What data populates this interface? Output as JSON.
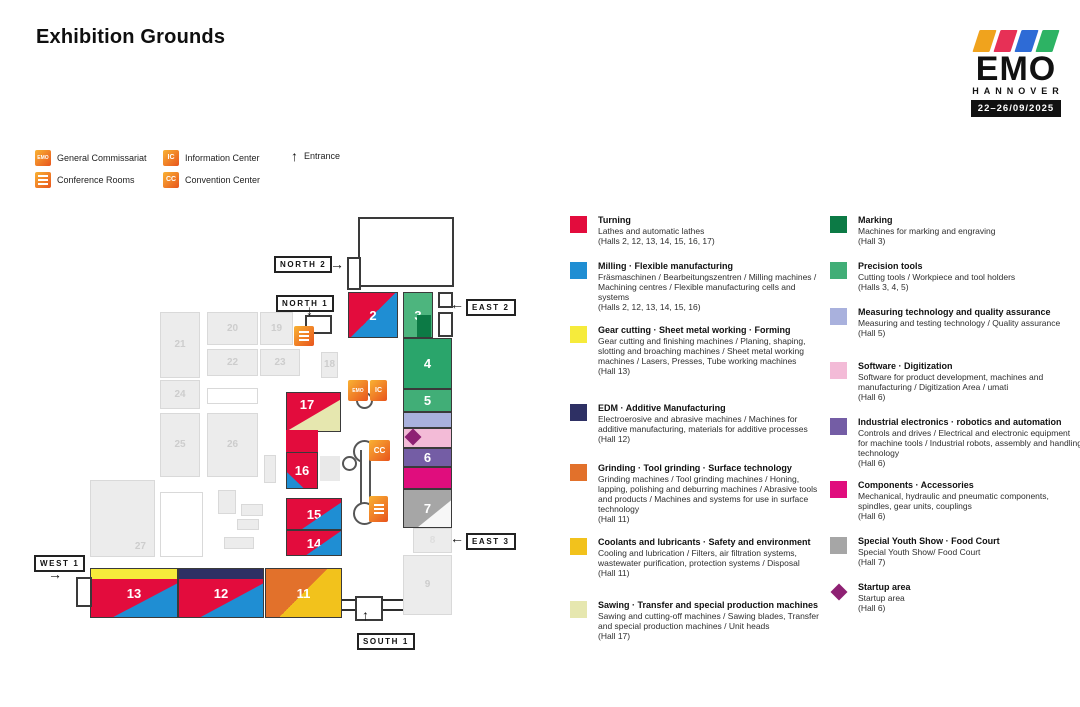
{
  "page": {
    "title": "Exhibition Grounds"
  },
  "logo": {
    "brand": "EMO",
    "city": "HANNOVER",
    "dates": "22–26/09/2025",
    "stripes": [
      "#f0a31d",
      "#e73056",
      "#2e6bd6",
      "#2db364"
    ]
  },
  "map_key": {
    "general_commissariat": {
      "glyph": "EMO",
      "label": "General Commissariat"
    },
    "information_center": {
      "glyph": "IC",
      "label": "Information Center"
    },
    "conference_rooms": {
      "glyph": "",
      "label": "Conference Rooms"
    },
    "convention_center": {
      "glyph": "CC",
      "label": "Convention Center"
    },
    "entrance": {
      "glyph": "↑",
      "label": "Entrance"
    }
  },
  "gates": [
    {
      "id": "north-2",
      "label": "NORTH 2",
      "arrow": "→"
    },
    {
      "id": "north-1",
      "label": "NORTH 1",
      "arrow": "↓"
    },
    {
      "id": "east-2",
      "label": "EAST 2",
      "arrow": "←"
    },
    {
      "id": "east-3",
      "label": "EAST 3",
      "arrow": "←"
    },
    {
      "id": "west-1",
      "label": "WEST 1",
      "arrow": "→"
    },
    {
      "id": "south-1",
      "label": "SOUTH 1",
      "arrow": "↑"
    }
  ],
  "hall_numbers": {
    "h2": "2",
    "h3": "3",
    "h4": "4",
    "h5": "5",
    "h6": "6",
    "h7": "7",
    "h8": "8",
    "h9": "9",
    "h11": "11",
    "h12": "12",
    "h13": "13",
    "h14": "14",
    "h15": "15",
    "h16": "16",
    "h17": "17",
    "h18": "18",
    "h19": "19",
    "h20": "20",
    "h21": "21",
    "h22": "22",
    "h23": "23",
    "h24": "24",
    "h25": "25",
    "h26": "26",
    "h27": "27"
  },
  "colors": {
    "turning_red": "#e30c3d",
    "milling_blue": "#1f8ed3",
    "gear_yellow": "#f6eb3b",
    "edm_navy": "#2e3064",
    "grinding_orange": "#e2712b",
    "coolants_gold": "#f2c21c",
    "sawing_cream": "#e6e7af",
    "marking_green": "#0c7a45",
    "precision_green": "#41ae77",
    "measuring_periwinkle": "#a9b1dd",
    "software_pink": "#f3bbd7",
    "industrial_purple": "#745da5",
    "components_magenta": "#e00d7d",
    "youth_gray": "#a6a6a6",
    "startup_plum": "#8e2173",
    "hall3_green": "#4db57e",
    "hall4_green": "#2aa56b",
    "hall_gray_fill": "#ececec",
    "hall_gray_border": "#d9d9d9",
    "hall_gray_number": "#cdcdcd",
    "outline_dark": "#3a3a3a",
    "icon_orange_a": "#f9b233",
    "icon_orange_b": "#e8541d"
  },
  "legend": {
    "columns": [
      [
        {
          "title": "Turning",
          "color": "turning_red",
          "shape": "square",
          "desc": "Lathes and automatic lathes",
          "halls": "(Halls 2, 12, 13, 14, 15, 16, 17)"
        },
        {
          "title": "Milling · Flexible manufacturing",
          "color": "milling_blue",
          "shape": "square",
          "desc": "Fräsmaschinen / Bearbeitungszentren / Milling machines / Machining centres / Flexible manufacturing cells and systems",
          "halls": "(Halls 2, 12, 13, 14, 15, 16)"
        },
        {
          "title": "Gear cutting · Sheet metal working · Forming",
          "color": "gear_yellow",
          "shape": "square",
          "desc": "Gear cutting and finishing machines / Planing, shaping, slotting and broaching machines / Sheet metal working machines / Lasers, Presses, Tube working machines",
          "halls": "(Hall 13)"
        },
        {
          "title": "EDM · Additive Manufacturing",
          "color": "edm_navy",
          "shape": "square",
          "desc": "Electroerosive and abrasive machines / Machines for additive manufacturing, materials for additive processes",
          "halls": "(Hall 12)"
        },
        {
          "title": "Grinding · Tool grinding · Surface technology",
          "color": "grinding_orange",
          "shape": "square",
          "desc": "Grinding machines / Tool grinding machines / Honing, lapping, polishing and deburring machines / Abrasive tools and products / Machines and systems for use in surface technology",
          "halls": "(Hall 11)"
        },
        {
          "title": "Coolants and lubricants · Safety and environment",
          "color": "coolants_gold",
          "shape": "square",
          "desc": "Cooling and lubrication / Filters, air filtration systems, wastewater purification, protection systems / Disposal",
          "halls": "(Hall 11)"
        },
        {
          "title": "Sawing · Transfer and special production machines",
          "color": "sawing_cream",
          "shape": "square",
          "desc": "Sawing and cutting-off machines / Sawing blades, Transfer and special production machines / Unit heads",
          "halls": "(Hall 17)"
        }
      ],
      [
        {
          "title": "Marking",
          "color": "marking_green",
          "shape": "square",
          "desc": "Machines for marking and engraving",
          "halls": "(Hall 3)"
        },
        {
          "title": "Precision tools",
          "color": "precision_green",
          "shape": "square",
          "desc": "Cutting tools / Workpiece and tool holders",
          "halls": "(Halls 3, 4, 5)"
        },
        {
          "title": "Measuring technology and quality assurance",
          "color": "measuring_periwinkle",
          "shape": "square",
          "desc": "Measuring and testing technology / Quality assurance",
          "halls": "(Hall 5)"
        },
        {
          "title": "Software · Digitization",
          "color": "software_pink",
          "shape": "square",
          "desc": "Software for product development, machines and manufacturing / Digitization Area / umati",
          "halls": "(Hall 6)"
        },
        {
          "title": "Industrial electronics · robotics and automation",
          "color": "industrial_purple",
          "shape": "square",
          "desc": "Controls and drives / Electrical and electronic equipment for machine tools / Industrial robots, assembly and handling technology",
          "halls": "(Hall 6)"
        },
        {
          "title": "Components · Accessories",
          "color": "components_magenta",
          "shape": "square",
          "desc": "Mechanical, hydraulic and pneumatic components, spindles, gear units, couplings",
          "halls": "(Hall 6)"
        },
        {
          "title": "Special Youth Show · Food Court",
          "color": "youth_gray",
          "shape": "square",
          "desc": "Special Youth Show/ Food Court",
          "halls": "(Hall 7)"
        },
        {
          "title": "Startup area",
          "color": "startup_plum",
          "shape": "diamond",
          "desc": "Startup area",
          "halls": "(Hall 6)"
        }
      ]
    ]
  }
}
